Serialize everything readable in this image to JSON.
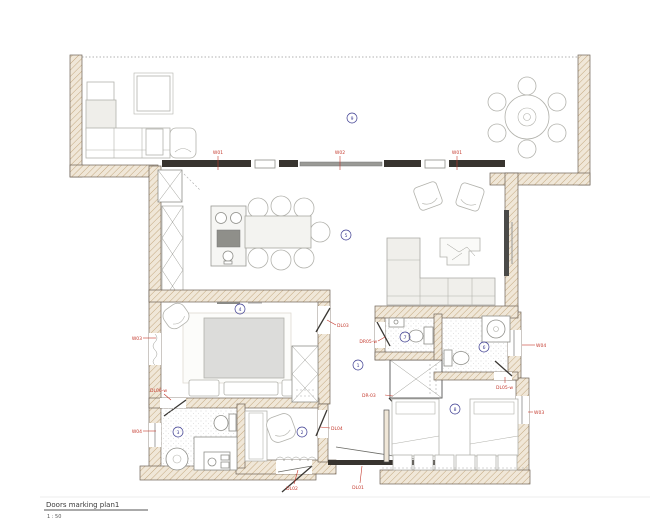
{
  "colors": {
    "marker_red": "#c4392d",
    "room_navy": "#3d3d91",
    "wall_dark": "#38342f",
    "wall_fill": "#f0e7d8",
    "wall_hatch_line": "#c3a87f"
  },
  "title_block": {
    "title": "Doors marking plan1",
    "scale": "1 : 50"
  },
  "window_markers": {
    "top_left": "W01",
    "top_center": "W02",
    "top_right": "W01",
    "left_upper": "W03",
    "left_lower": "W04",
    "right_upper": "W04",
    "right_lower": "W03"
  },
  "door_markers": {
    "master_bedroom": "DL03",
    "small_bathroom": "DR05-w",
    "master_bath": "DL06-w",
    "closet": "DR-03",
    "wc_bedroom": "DL05-w",
    "entry_corridor": "DL04",
    "entrance": "DL02",
    "corridor_sliding": "DL01"
  },
  "room_numbers": {
    "corridor": "1",
    "entry_hall": "2",
    "bathroom_main": "3",
    "bedroom_master": "4",
    "living_dining": "5",
    "wc": "6",
    "bathroom_small": "7",
    "bedroom_second": "8",
    "terrace": "9"
  }
}
